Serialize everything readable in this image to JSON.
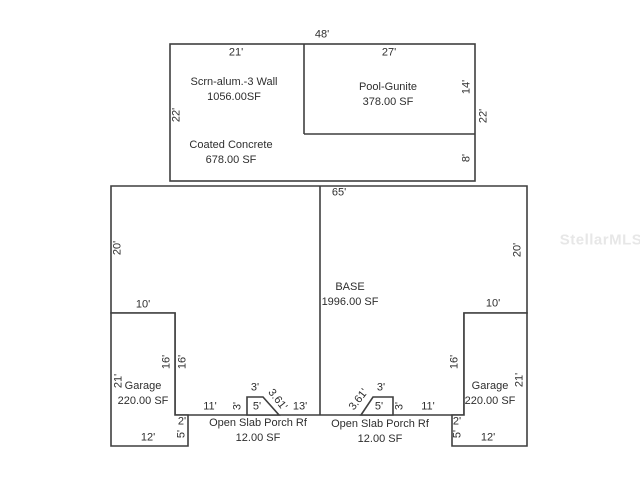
{
  "watermark": "StellarMLS",
  "colors": {
    "line": "#3f3f3f",
    "text": "#2e2e2e",
    "watermark": "#e7e7e7",
    "background": "#ffffff"
  },
  "areas": {
    "screen": {
      "label": "Scrn-alum.-3 Wall",
      "area": "1056.00SF"
    },
    "pool": {
      "label": "Pool-Gunite",
      "area": "378.00 SF"
    },
    "concrete": {
      "label": "Coated Concrete",
      "area": "678.00 SF"
    },
    "base": {
      "label": "BASE",
      "area": "1996.00 SF"
    },
    "garage_left": {
      "label": "Garage",
      "area": "220.00 SF"
    },
    "garage_right": {
      "label": "Garage",
      "area": "220.00 SF"
    },
    "porch_left": {
      "label": "Open Slab Porch Rf",
      "area": "12.00 SF"
    },
    "porch_right": {
      "label": "Open Slab Porch Rf",
      "area": "12.00 SF"
    }
  },
  "dims": {
    "top_total_width": "48'",
    "screen_width": "21'",
    "pool_width": "27'",
    "screen_height": "22'",
    "pool_height": "14'",
    "top_right_height": "22'",
    "deck_height": "8'",
    "base_width": "65'",
    "base_height_left": "20'",
    "base_height_right": "20'",
    "garage_left_top": "10'",
    "garage_right_top": "10'",
    "notch_left_inner": "16'",
    "notch_left_outer": "16'",
    "notch_right": "16'",
    "garage_left_height": "21'",
    "garage_right_height": "21'",
    "garage_left_bottom": "12'",
    "garage_right_bottom": "12'",
    "step_left_width": "2'",
    "step_left_height": "5'",
    "step_right_width": "2'",
    "step_right_height": "5'",
    "porch_left_offset": "11'",
    "porch_left_side": "3'",
    "porch_left_top": "3'",
    "porch_left_bottom": "5'",
    "porch_left_diag": "3.61'",
    "porch_center_span": "13'",
    "porch_right_diag": "3.61'",
    "porch_right_top": "3'",
    "porch_right_bottom": "5'",
    "porch_right_side": "3'",
    "porch_right_offset": "11'"
  }
}
